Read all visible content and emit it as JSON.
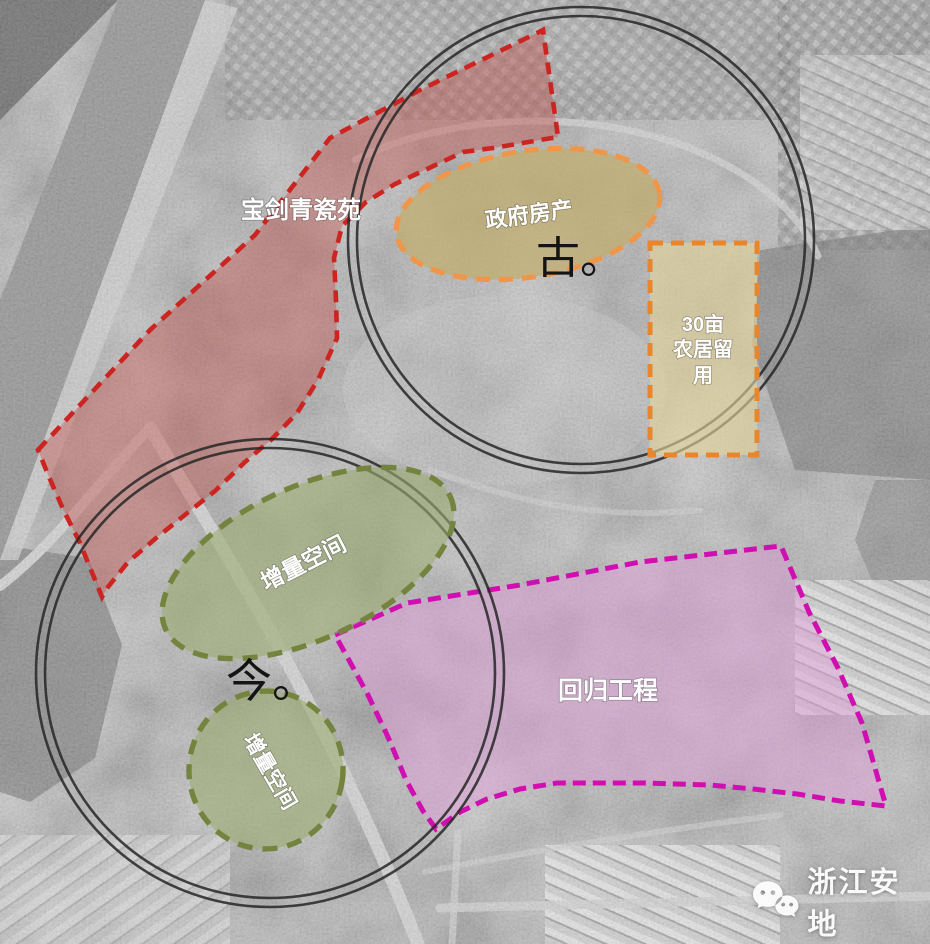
{
  "diagram": {
    "type": "urban-planning-site-analysis-over-satellite",
    "ring_color": "#262626",
    "markers": {
      "ancient": {
        "label": "古。"
      },
      "modern": {
        "label": "今。"
      }
    },
    "zones": {
      "baojian": {
        "label": "宝剑青瓷苑",
        "border_color": "#cc2420",
        "fill_color": "#c0504a"
      },
      "government_property": {
        "label": "政府房产",
        "border_color": "#f0964a",
        "fill_color": "#c2ad6d"
      },
      "farm_reserve": {
        "label": "30亩农居留用",
        "lines": [
          "30亩",
          "农居留",
          "用"
        ],
        "border_color": "#e8862e",
        "fill_color": "#e3d398"
      },
      "increment_upper": {
        "label": "增量空间",
        "border_color": "#74843e",
        "fill_color": "#9cab72"
      },
      "increment_lower": {
        "label": "增量空间",
        "border_color": "#74843e",
        "fill_color": "#9cab72"
      },
      "return_project": {
        "label": "回归工程",
        "border_color": "#cf0fb0",
        "fill_color": "#dd9ed8"
      }
    },
    "watermark": {
      "text": "浙江安地",
      "icon": "wechat-icon"
    }
  }
}
